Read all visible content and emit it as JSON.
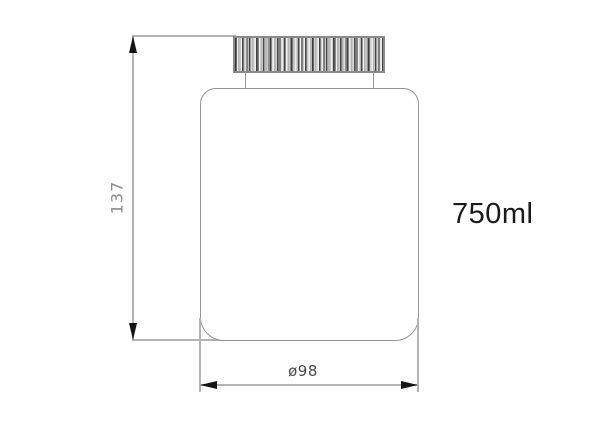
{
  "drawing": {
    "type": "technical-drawing",
    "subject": "bottle-with-ribbed-cap",
    "volume_label": "750ml",
    "height_dimension": {
      "label": "137",
      "orientation": "vertical"
    },
    "diameter_dimension": {
      "label": "ø98",
      "orientation": "horizontal"
    }
  },
  "colors": {
    "background": "#ffffff",
    "line_gray": "#b3b3b3",
    "outline_gray": "#949494",
    "cap_border_gray": "#8a8a8a",
    "arrow_black": "#151515",
    "dim_text_gray": "#8c8c8c",
    "dia_text_dark": "#4a4a4a",
    "label_black": "#1a1a1a"
  }
}
